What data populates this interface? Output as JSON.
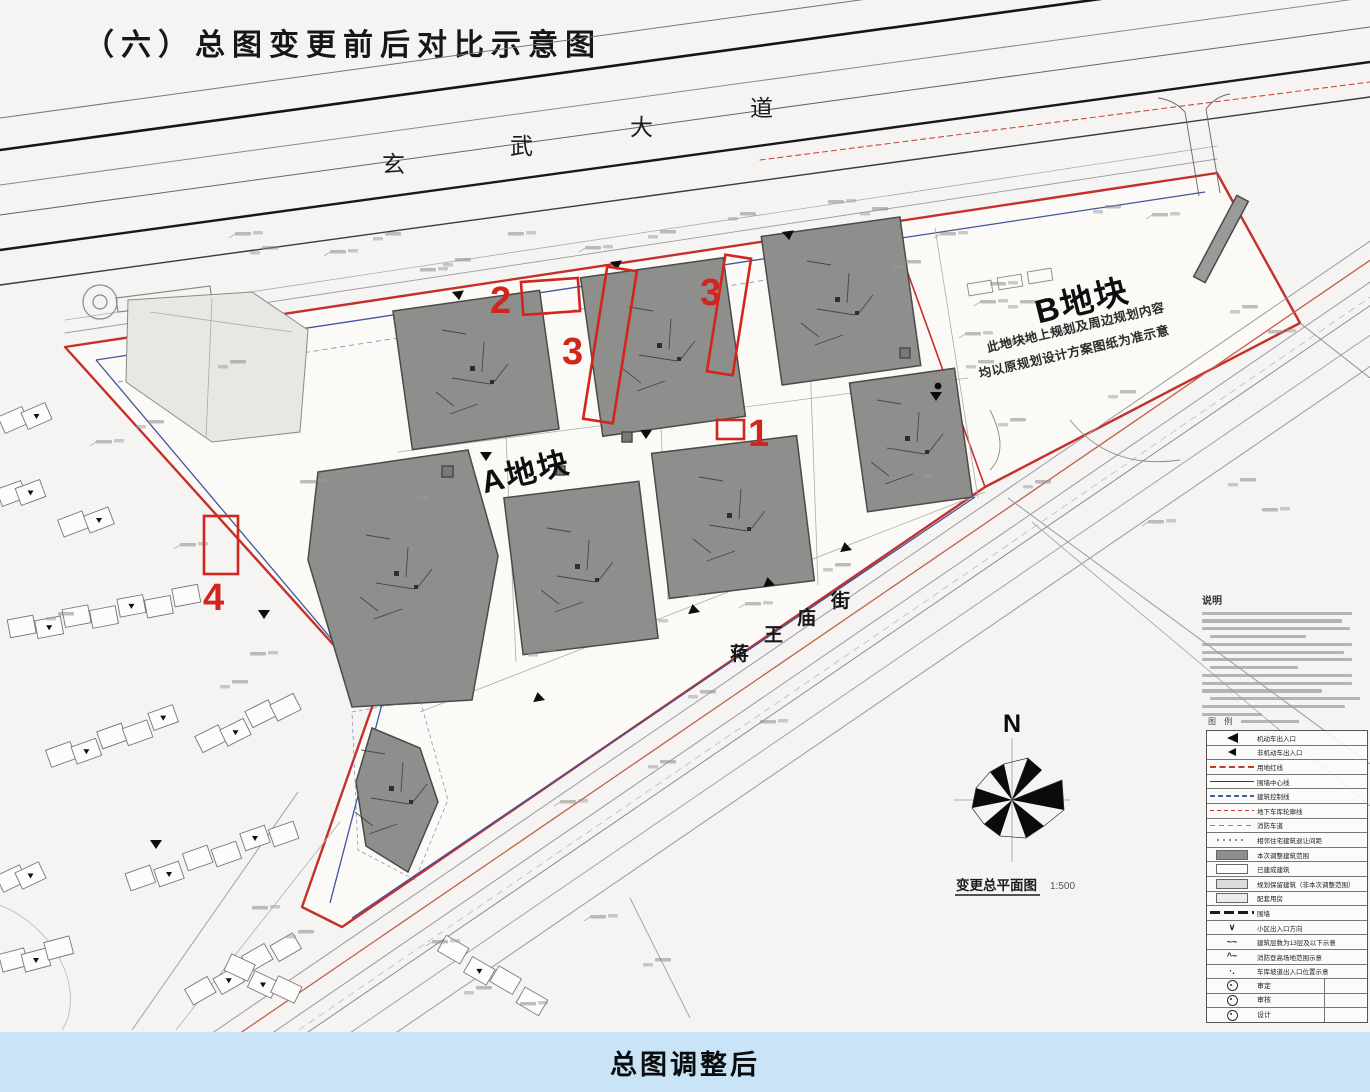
{
  "title": "（六）总图变更前后对比示意图",
  "banner": {
    "text": "总图调整后",
    "bg_color": "#c9e4f7"
  },
  "colors": {
    "boundary_red": "#c5302a",
    "inner_blue": "#41549e",
    "building_gray": "#8e8e8c",
    "marker_red": "#d2251d",
    "banner_blue": "#c9e4f7"
  },
  "map": {
    "road_xuanwu": {
      "name": "玄武大道",
      "chars": [
        "玄",
        "武",
        "大",
        "道"
      ]
    },
    "road_jiangwangmiao": {
      "name": "蒋王庙街",
      "chars": [
        "蒋",
        "王",
        "庙",
        "街"
      ]
    },
    "plot_a_label": "A地块",
    "plot_b_label": "B地块",
    "plot_b_note_line1": "此地块地上规划及周边规划内容",
    "plot_b_note_line2": "均以原规划设计方案图纸为准示意",
    "north_label": "N",
    "drawing_label": "变更总平面图",
    "drawing_scale": "1:500",
    "markers": [
      {
        "n": "1"
      },
      {
        "n": "2"
      },
      {
        "n": "3"
      },
      {
        "n": "3"
      },
      {
        "n": "4"
      }
    ]
  },
  "notes": {
    "heading": "说明"
  },
  "legend": {
    "heading": "图 例",
    "rows": [
      {
        "label": "机动车出入口"
      },
      {
        "label": "非机动车出入口"
      },
      {
        "label": "用地红线"
      },
      {
        "label": "围墙中心线"
      },
      {
        "label": "建筑控制线"
      },
      {
        "label": "地下车库轮廓线"
      },
      {
        "label": "消防车道"
      },
      {
        "label": "相邻住宅建筑退让间距"
      },
      {
        "label": "本次调整建筑范围"
      },
      {
        "label": "已建成建筑"
      },
      {
        "label": "规划保留建筑（非本次调整范围）"
      },
      {
        "label": "配套用房"
      },
      {
        "label": "围墙"
      },
      {
        "label": "小区出入口方向"
      },
      {
        "label": "建筑层数为13层及以下示意"
      },
      {
        "label": "消防登高场地范围示意"
      },
      {
        "label": "车库坡道出入口位置示意"
      }
    ],
    "footer_rows": [
      {
        "label": "审定"
      },
      {
        "label": "审核"
      },
      {
        "label": "设计"
      }
    ]
  }
}
